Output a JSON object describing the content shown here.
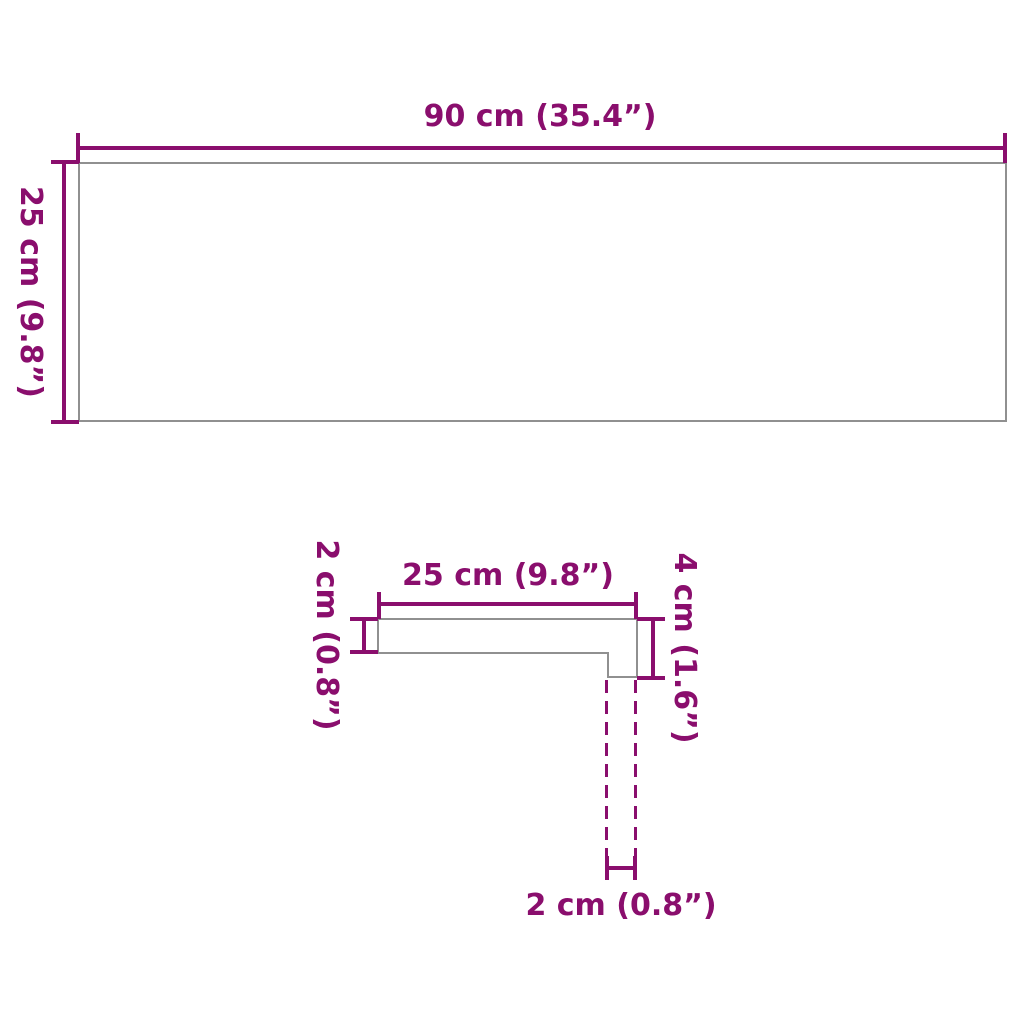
{
  "colors": {
    "dimension": "#8A0E6D",
    "outline": "#909090",
    "background": "#FFFFFF"
  },
  "top_view": {
    "width_label": "90 cm (35.4”)",
    "height_label": "25 cm (9.8”)"
  },
  "profile_view": {
    "width_label": "25 cm (9.8”)",
    "thickness_label": "2 cm (0.8”)",
    "nose_height_label": "4 cm (1.6”)",
    "nose_width_label": "2 cm (0.8”)"
  }
}
